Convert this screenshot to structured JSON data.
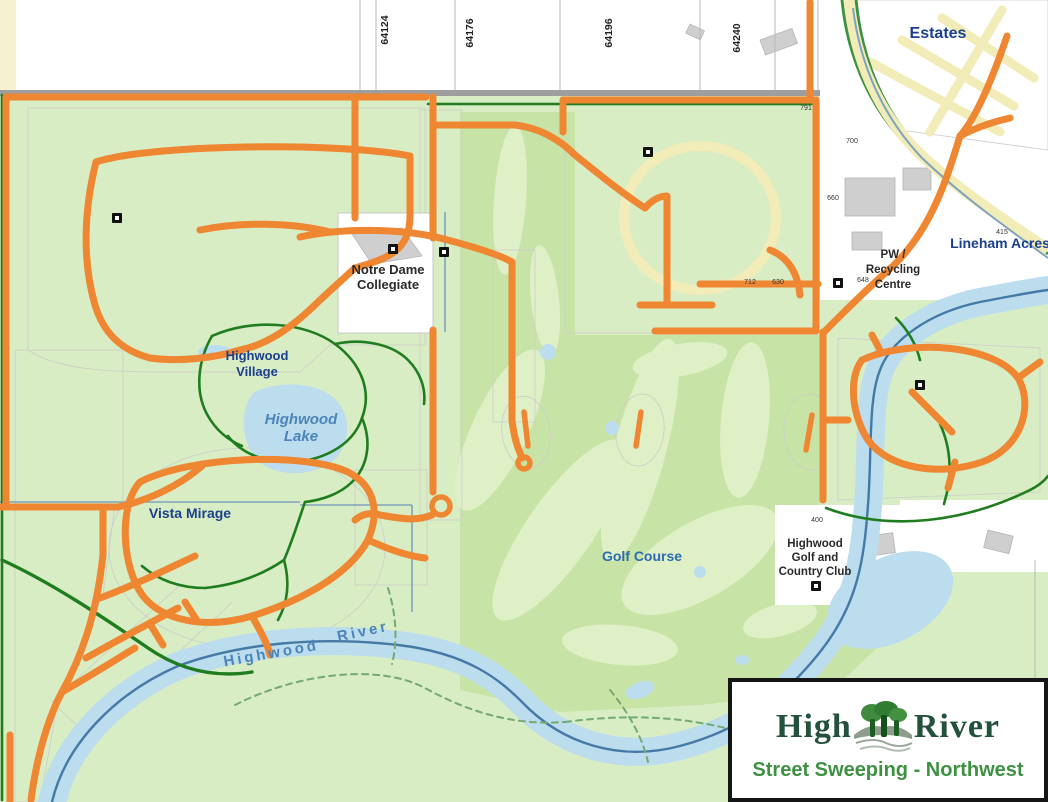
{
  "title": "Street Sweeping - Northwest",
  "logo": {
    "brand_left": "High",
    "brand_right": "River",
    "subtitle": "Street Sweeping - Northwest"
  },
  "labels": {
    "estates": "Estates",
    "lineham_acres": "Lineham Acres",
    "pw_recycling": [
      "PW /",
      "Recycling",
      "Centre"
    ],
    "notre_dame": [
      "Notre Dame",
      "Collegiate"
    ],
    "highwood_village": [
      "Highwood",
      "Village"
    ],
    "highwood_lake": [
      "Highwood",
      "Lake"
    ],
    "vista_mirage": "Vista Mirage",
    "golf_course": "Golf Course",
    "country_club": [
      "Highwood",
      "Golf and",
      "Country Club"
    ],
    "river_word1": "Highwood",
    "river_word2": "River"
  },
  "grid_numbers": [
    {
      "text": "64124",
      "x": 388,
      "y": 30
    },
    {
      "text": "64176",
      "x": 473,
      "y": 33
    },
    {
      "text": "64196",
      "x": 612,
      "y": 33
    },
    {
      "text": "64240",
      "x": 740,
      "y": 38
    }
  ],
  "parcel_numbers": [
    {
      "text": "791",
      "x": 806,
      "y": 110
    },
    {
      "text": "700",
      "x": 852,
      "y": 143
    },
    {
      "text": "660",
      "x": 833,
      "y": 200
    },
    {
      "text": "712",
      "x": 750,
      "y": 284
    },
    {
      "text": "630",
      "x": 778,
      "y": 284
    },
    {
      "text": "648",
      "x": 863,
      "y": 282
    },
    {
      "text": "415",
      "x": 1002,
      "y": 234
    },
    {
      "text": "400",
      "x": 817,
      "y": 522
    }
  ],
  "icons": [
    {
      "x": 117,
      "y": 218
    },
    {
      "x": 393,
      "y": 249
    },
    {
      "x": 444,
      "y": 252
    },
    {
      "x": 648,
      "y": 152
    },
    {
      "x": 838,
      "y": 283
    },
    {
      "x": 920,
      "y": 385
    },
    {
      "x": 816,
      "y": 586
    }
  ],
  "colors": {
    "orange": "#EF8632",
    "park": "#D8EDC3",
    "golf": "#C8E3A6",
    "fairway": "#DFF0C6",
    "water": "#BCDDEE",
    "riverline": "#4579A6",
    "pathgreen": "#1F7D1F",
    "trail": "#74A874",
    "roadgray": "#9E9E9E",
    "hwycream": "#F2ECB8",
    "hwyedge": "#3F9142",
    "parcel": "#C4C4C4",
    "boundary": "#7FA3BC",
    "navy": "#1B3F8F",
    "lblblue": "#2B6CB0",
    "waterlbl": "#4B84B8",
    "lbldark": "#2A2A2A",
    "logogreen": "#24513B",
    "subgreen": "#3E9142"
  }
}
